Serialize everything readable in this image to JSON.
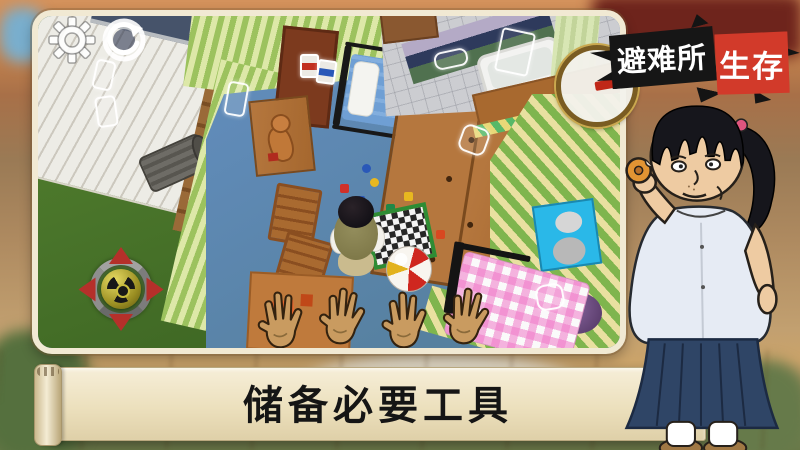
{
  "window": {
    "width": 800,
    "height": 450
  },
  "logo": {
    "title_part1": "避难所",
    "title_part2": "生存",
    "black_bg": "#161616",
    "red_bg": "#d23a2a",
    "text_color": "#ffffff"
  },
  "banner": {
    "text": "储备必要工具",
    "bg_color": "#efe4c4",
    "text_color": "#151515"
  },
  "hud": {
    "settings_icon": "gear-icon",
    "rotate_icon": "camera-rotate-icon",
    "joystick": {
      "center_symbol": "radiation-trefoil",
      "arrow_color": "#b5302a",
      "ring_color": "#8e8e8e"
    }
  },
  "scene": {
    "objects": [
      "wood-deck",
      "pool-edge",
      "trash-cans",
      "grass",
      "kids-bedroom",
      "striped-wallpaper",
      "blue-carpet",
      "metal-bed",
      "wardrobe",
      "desk-with-teddy",
      "wooden-chairs",
      "scattered-toys",
      "checkerboard",
      "beach-ball",
      "player-top-view",
      "reaching-hands",
      "bathroom",
      "bathtub",
      "shower-curtain",
      "pink-gingham-bed",
      "red-poster",
      "marilyn-poster",
      "magnifying-glass",
      "collectible-outlines"
    ]
  },
  "character": {
    "name": "girl-eating-donut"
  }
}
